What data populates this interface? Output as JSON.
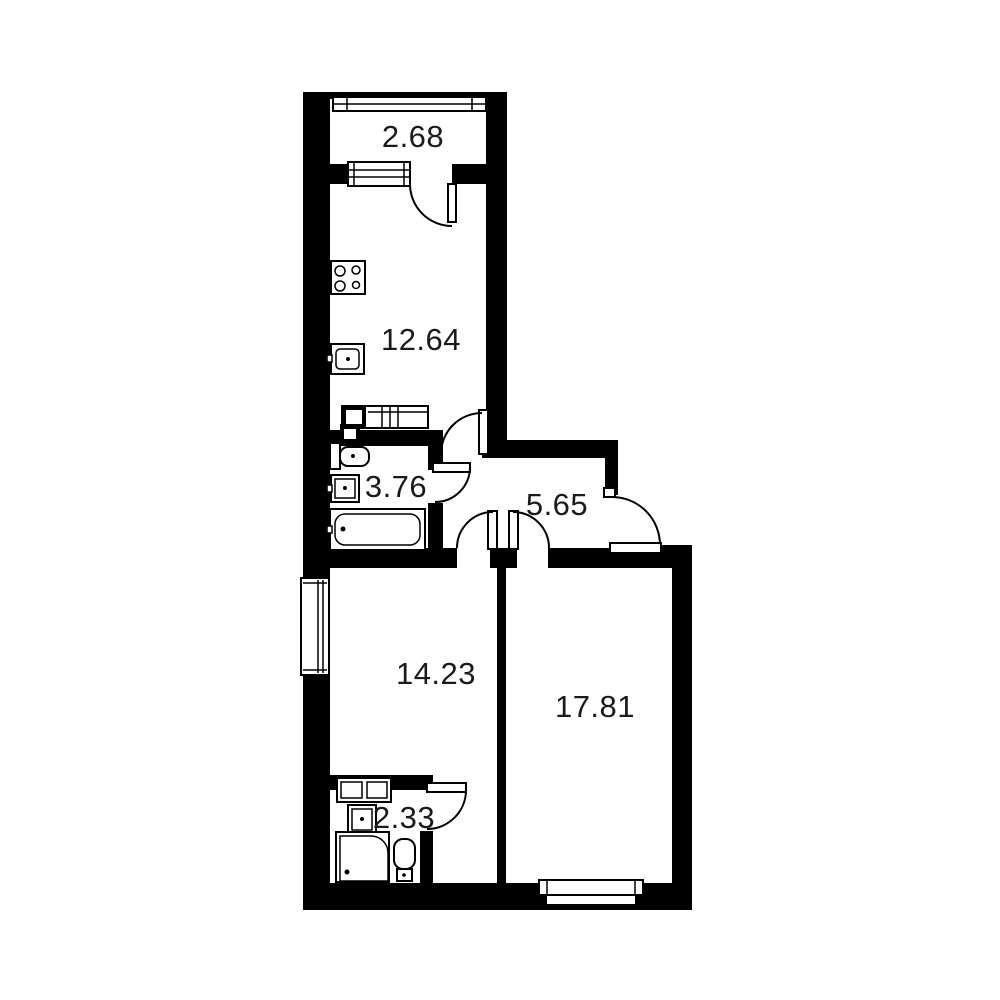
{
  "plan": {
    "type": "apartment-floor-plan",
    "colors": {
      "wall": "#000000",
      "background": "#ffffff",
      "label_text": "#1a1a1a"
    },
    "rooms": [
      {
        "id": "balcony",
        "area": "2.68"
      },
      {
        "id": "kitchen",
        "area": "12.64"
      },
      {
        "id": "bathroom",
        "area": "3.76"
      },
      {
        "id": "hallway",
        "area": "5.65"
      },
      {
        "id": "room-left",
        "area": "14.23"
      },
      {
        "id": "room-right",
        "area": "17.81"
      },
      {
        "id": "shower-room",
        "area": "2.33"
      }
    ]
  }
}
